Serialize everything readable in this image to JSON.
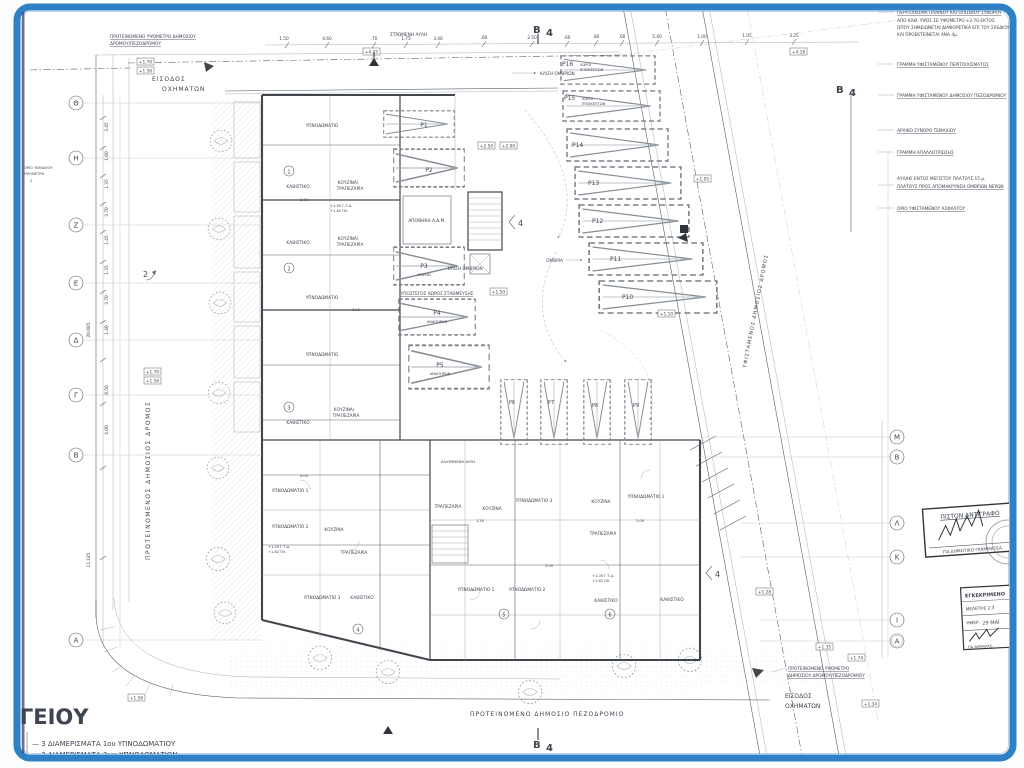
{
  "meta": {
    "document_kind": "architectural-site-plan",
    "language": "el"
  },
  "frame": {
    "border_color": "#2e81c4",
    "paper_color": "#ffffff"
  },
  "title_fragment": "ΟΓΕΙΟΥ",
  "legend": {
    "item1": "— 3 ΔΙΑΜΕΡΙΣΜΑΤΑ 1ου ΥΠΝΟΔΩΜΑΤΙΟΥ",
    "item2": "— 3 ΔΙΑΜΕΡΙΣΜΑΤΑ 3ων ΥΠΝΟΔΩΜΑΤΙΩΝ"
  },
  "notes": [
    "ΠΕΡΙΤΟΙΧΙΣΜΑ ΠΛΑΪΝΟΥ ΚΑΙ ΟΠΙΣΘΙΟΥ ΣΥΝΟΡΟΥ",
    "ΑΠΟ ΚΑΘ. ΥΨΟΣ ΣΕ ΥΨΟΜΕΤΡΟ +2.70 ΕΚΤΟΣ",
    "ΟΠΟΥ ΣΗΜΕΙΩΝΕΤΑΙ ΔΙΑΦΟΡΕΤΙΚΑ ΕΠΙ ΤΟΥ ΣΧΕΔΙΟΥ",
    "ΚΑΙ ΠΡΟΕΚΤΕΙΝΕΤΑΙ ΑΝΑ 4μ.",
    "ΓΡΑΜΜΗ ΥΦΙΣΤΑΜΕΝΟΥ ΠΕΡΙΤΟΙΧΙΣΜΑΤΟΣ",
    "ΓΡΑΜΜΗ ΥΦΙΣΤΑΜΕΝΟΥ ΔΗΜΟΣΙΟΥ ΠΕΖΟΔΡΟΜΙΟΥ",
    "ΑΡΧΙΚΟ ΣΥΝΟΡΟ ΤΕΜΑΧΙΟΥ",
    "ΓΡΑΜΜΗ ΑΠΑΛΛΟΤΡΙΩΣΗΣ",
    "ΑΥΛΑΚΙ ΕΝΤΟΣ ΜΕΓΙΣΤΟΥ ΠΛΑΤΟΥΣ 15 μ.",
    "ΠΛΑΤΟΥΣ ΠΡΟΣ ΑΠΟΜΑΚΡΥΝΣΗ ΟΜΒΡΙΩΝ ΝΕΡΩΝ",
    "ΟΡΙΟ ΥΦΙΣΤΑΜΕΝΟΥ ΑΣΦΑΛΤΟΥ"
  ],
  "stamps": {
    "certified": {
      "title": "ΠΙΣΤΟΝ ΑΝΤΙΓΡΑΦΟ",
      "subtitle": "ΓΙΑ ΔΗΜΟΤΙΚΟ ΓΡΑΜΜΑΤΕΑ"
    },
    "approved": {
      "title": "ΕΓΚΕΚΡΙΜΕΝΟ",
      "ref": "ΜΕΛΕΤΗΣ 2.3",
      "date_label": "ΗΜΕΡ.",
      "date": "29 ΜΑΪ",
      "signoff": "ΓΙΑ ΔΗΜΑΡΧΟ"
    }
  },
  "grid_left": [
    "Θ",
    "Η",
    "Ζ",
    "Ε",
    "Δ",
    "Γ",
    "Β",
    "Α"
  ],
  "grid_right": [
    "Μ",
    "Β",
    "Λ",
    "Κ",
    "Ι",
    "Α"
  ],
  "roads": {
    "west": "ΠΡΟΤΕΙΝΟΜΕΝΟΣ ΔΗΜΟΣΙΟΣ ΔΡΟΜΟΣ",
    "east": "ΥΦΙΣΤΑΜΕΝΟΣ ΔΗΜΟΣΙΟΣ ΔΡΟΜΟΣ",
    "south": "ΠΡΟΤΕΙΝΟΜΕΝΟ ΔΗΜΟΣΙΟ ΠΕΖΟΔΡΟΜΙΟ"
  },
  "entries": {
    "label1": "ΕΙΣΟΔΟΣ",
    "label2": "ΟΧΗΜΑΤΩΝ",
    "note_top1": "ΠΡΟΤΕΙΝΟΜΕΝΟ ΥΨΟΜΕΤΡΟ ΔΗΜΟΣΙΟΥ",
    "note_top2": "ΔΡΟΜΟΥ/ΠΕΖΟΔΡΟΜΟΥ",
    "note_bottom1": "ΠΡΟΤΕΙΝΟΜΕΝΟ ΥΨΟΜΕΤΡΟ",
    "note_bottom2": "ΔΗΜΟΣΙΟΥ ΔΡΟΜΟΥ/ΠΕΖΟΔΡΟΜΙΟΥ"
  },
  "site": {
    "yard": "ΣΤΡΩΜΕΝΗ ΑΥΛΗ",
    "slope": "ΚΛΙΣΗ ΟΜΒΡΙΩΝ",
    "storm": "ΟΜΒΡΙΑ",
    "boundary_small1": "ΟΡΙΟ ΤΕΜΑΧΙΟΥ",
    "boundary_small2": "ΥΨΟΜΕΤΡΑ",
    "compass": "2"
  },
  "parking": {
    "p": [
      "P1",
      "P2",
      "P3",
      "P4",
      "P5",
      "P6",
      "P7",
      "P8",
      "P9",
      "P10",
      "P11",
      "P12",
      "P13",
      "P14",
      "P15",
      "P16"
    ],
    "disabled": "ΑΝΑΠΗΡΩΝ",
    "baby": "ΜΩΡΩΝ",
    "visitors1": "ΧΩΡΟΙ",
    "visitors2": "ΕΠΙΣΚΕΠΤΩΝ",
    "covered": "ΥΠΟΣΤΕΓΟΣ ΧΩΡΟΣ ΣΤΑΘΜΕΥΣΗΣ",
    "storage": "ΑΠΟΘΗΚΗ Α.Δ.Μ."
  },
  "rooms": {
    "bedroom": "ΥΠΝΟΔΩΜΑΤΙΟ",
    "bedroom1": "ΥΠΝΟΔΩΜΑΤΙΟ 1",
    "bedroom2": "ΥΠΝΟΔΩΜΑΤΙΟ 2",
    "bedroom3": "ΥΠΝΟΔΩΜΑΤΙΟ 3",
    "living": "ΚΑΘΙΣΤΙΚΟ",
    "kitchen": "ΚΟΥΖΙΝΑ",
    "dining": "ΤΡΑΠΕΖΑΡΙΑ",
    "kitchen_slash": "ΚΟΥΖΙΝΑ/",
    "covered_yard": "ΚΑΛΥΜΜΕΝΗ ΑΥΛΗ"
  },
  "units": [
    "1",
    "2",
    "3",
    "4",
    "5",
    "6"
  ],
  "levels": {
    "gtd": "+1.05 Γ.Τ.Δ.",
    "pl": "+1.82 ΠΛ."
  },
  "elevations": [
    "+2.50",
    "+2.00",
    "+1.50",
    "+1.05",
    "+1.10",
    "+1.28",
    "+1.35",
    "+1.74",
    "+1.34",
    "+1.70",
    "+1.56",
    "+4.25",
    "+4.18"
  ],
  "dims_top": [
    "1.50",
    "4.60",
    ".70",
    "1.75",
    "3.40",
    ".60",
    "2.50",
    ".60",
    ".80",
    ".60",
    "5.40",
    "1.00",
    "1.05",
    "3.25"
  ],
  "dims_left": [
    "3.45",
    "1.60",
    "1.35",
    "3.70",
    "1.45",
    "1.35",
    "3.70",
    "1.40",
    "8.50",
    "4.00",
    "20.085",
    "11.185"
  ],
  "dims_inner": [
    "3.70",
    "4.00",
    "1.20",
    "3.00",
    "2.00",
    "3.10"
  ],
  "section": {
    "letter": "Β",
    "number": "4"
  }
}
